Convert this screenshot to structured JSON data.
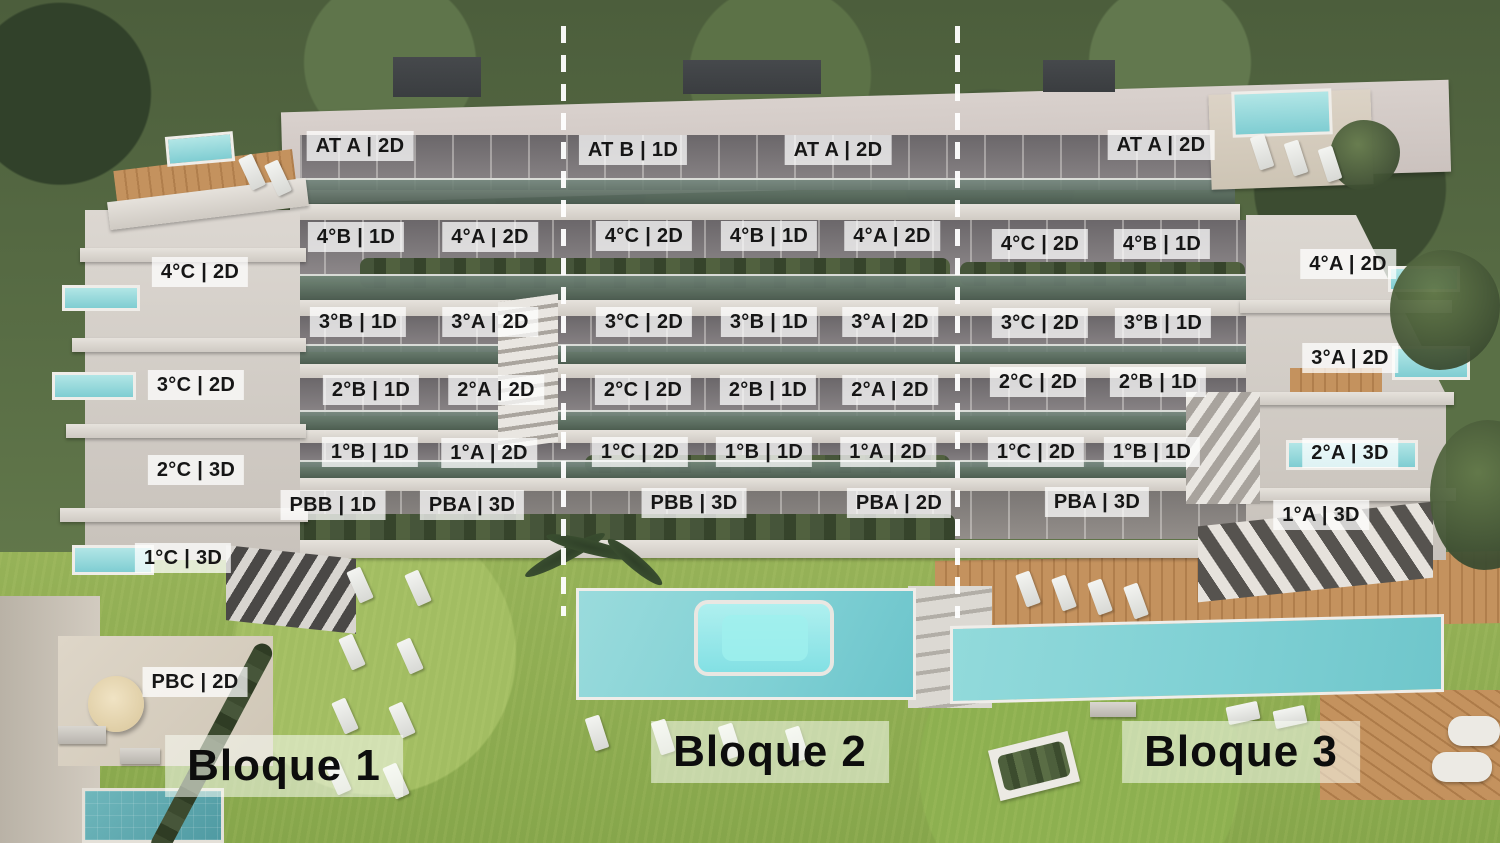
{
  "image": {
    "width": 1500,
    "height": 843
  },
  "colors": {
    "unit_label_bg": "rgba(255,255,255,0.74)",
    "unit_label_text": "#161616",
    "block_label_bg": "rgba(250,253,244,0.55)",
    "divider_line": "#ffffff",
    "building_light": "#dcd7d1",
    "facade_dark": "#6b676a",
    "balcony_glass": "#64736a",
    "hedge_green": "#46553a",
    "trees_green": "#4c5e3c",
    "grass_green": "#96b258",
    "wood_deck": "#c4925e",
    "pool_teal": "#7fd0d4",
    "ground_pool_teal": "#4f9aa2"
  },
  "block_labels": [
    {
      "text": "Bloque 1",
      "x": 284,
      "y": 766
    },
    {
      "text": "Bloque 2",
      "x": 770,
      "y": 752
    },
    {
      "text": "Bloque 3",
      "x": 1241,
      "y": 752
    }
  ],
  "unit_labels": [
    {
      "text": "AT A | 2D",
      "block": 1,
      "x": 360,
      "y": 146
    },
    {
      "text": "4°B | 1D",
      "block": 1,
      "x": 356,
      "y": 237
    },
    {
      "text": "4°A | 2D",
      "block": 1,
      "x": 490,
      "y": 237
    },
    {
      "text": "4°C | 2D",
      "block": 1,
      "x": 200,
      "y": 272
    },
    {
      "text": "3°B | 1D",
      "block": 1,
      "x": 358,
      "y": 322
    },
    {
      "text": "3°A | 2D",
      "block": 1,
      "x": 490,
      "y": 322
    },
    {
      "text": "3°C | 2D",
      "block": 1,
      "x": 196,
      "y": 385
    },
    {
      "text": "2°B | 1D",
      "block": 1,
      "x": 371,
      "y": 390
    },
    {
      "text": "2°A | 2D",
      "block": 1,
      "x": 496,
      "y": 390
    },
    {
      "text": "1°B | 1D",
      "block": 1,
      "x": 370,
      "y": 452
    },
    {
      "text": "1°A | 2D",
      "block": 1,
      "x": 489,
      "y": 453
    },
    {
      "text": "2°C | 3D",
      "block": 1,
      "x": 196,
      "y": 470
    },
    {
      "text": "PBB | 1D",
      "block": 1,
      "x": 333,
      "y": 505
    },
    {
      "text": "PBA | 3D",
      "block": 1,
      "x": 472,
      "y": 505
    },
    {
      "text": "1°C | 3D",
      "block": 1,
      "x": 183,
      "y": 558
    },
    {
      "text": "PBC | 2D",
      "block": 1,
      "x": 195,
      "y": 682
    },
    {
      "text": "AT B | 1D",
      "block": 2,
      "x": 633,
      "y": 150
    },
    {
      "text": "AT A | 2D",
      "block": 2,
      "x": 838,
      "y": 150
    },
    {
      "text": "4°C | 2D",
      "block": 2,
      "x": 644,
      "y": 236
    },
    {
      "text": "4°B | 1D",
      "block": 2,
      "x": 769,
      "y": 236
    },
    {
      "text": "4°A | 2D",
      "block": 2,
      "x": 892,
      "y": 236
    },
    {
      "text": "3°C | 2D",
      "block": 2,
      "x": 644,
      "y": 322
    },
    {
      "text": "3°B | 1D",
      "block": 2,
      "x": 769,
      "y": 322
    },
    {
      "text": "3°A | 2D",
      "block": 2,
      "x": 890,
      "y": 322
    },
    {
      "text": "2°C | 2D",
      "block": 2,
      "x": 643,
      "y": 390
    },
    {
      "text": "2°B | 1D",
      "block": 2,
      "x": 768,
      "y": 390
    },
    {
      "text": "2°A | 2D",
      "block": 2,
      "x": 890,
      "y": 390
    },
    {
      "text": "1°C | 2D",
      "block": 2,
      "x": 640,
      "y": 452
    },
    {
      "text": "1°B | 1D",
      "block": 2,
      "x": 764,
      "y": 452
    },
    {
      "text": "1°A | 2D",
      "block": 2,
      "x": 888,
      "y": 452
    },
    {
      "text": "PBB | 3D",
      "block": 2,
      "x": 694,
      "y": 503
    },
    {
      "text": "PBA | 2D",
      "block": 2,
      "x": 899,
      "y": 503
    },
    {
      "text": "AT A | 2D",
      "block": 3,
      "x": 1161,
      "y": 145
    },
    {
      "text": "4°C | 2D",
      "block": 3,
      "x": 1040,
      "y": 244
    },
    {
      "text": "4°B | 1D",
      "block": 3,
      "x": 1162,
      "y": 244
    },
    {
      "text": "4°A | 2D",
      "block": 3,
      "x": 1348,
      "y": 264
    },
    {
      "text": "3°C | 2D",
      "block": 3,
      "x": 1040,
      "y": 323
    },
    {
      "text": "3°B | 1D",
      "block": 3,
      "x": 1163,
      "y": 323
    },
    {
      "text": "3°A | 2D",
      "block": 3,
      "x": 1350,
      "y": 358
    },
    {
      "text": "2°C | 2D",
      "block": 3,
      "x": 1038,
      "y": 382
    },
    {
      "text": "2°B | 1D",
      "block": 3,
      "x": 1158,
      "y": 382
    },
    {
      "text": "1°C | 2D",
      "block": 3,
      "x": 1036,
      "y": 452
    },
    {
      "text": "1°B | 1D",
      "block": 3,
      "x": 1152,
      "y": 452
    },
    {
      "text": "2°A | 3D",
      "block": 3,
      "x": 1350,
      "y": 453
    },
    {
      "text": "PBA | 3D",
      "block": 3,
      "x": 1097,
      "y": 502
    },
    {
      "text": "1°A | 3D",
      "block": 3,
      "x": 1321,
      "y": 515
    }
  ],
  "dividers": [
    {
      "x": 561,
      "top": 26,
      "height": 590
    },
    {
      "x": 955,
      "top": 26,
      "height": 592
    }
  ],
  "loungers": [
    {
      "x": 360,
      "y": 585,
      "r": -24
    },
    {
      "x": 418,
      "y": 588,
      "r": -24
    },
    {
      "x": 352,
      "y": 652,
      "r": -24
    },
    {
      "x": 410,
      "y": 656,
      "r": -24
    },
    {
      "x": 345,
      "y": 716,
      "r": -24
    },
    {
      "x": 402,
      "y": 720,
      "r": -24
    },
    {
      "x": 338,
      "y": 777,
      "r": -24
    },
    {
      "x": 396,
      "y": 781,
      "r": -24
    },
    {
      "x": 597,
      "y": 733,
      "r": -18
    },
    {
      "x": 663,
      "y": 737,
      "r": -18
    },
    {
      "x": 730,
      "y": 741,
      "r": -18
    },
    {
      "x": 797,
      "y": 744,
      "r": -18
    },
    {
      "x": 1028,
      "y": 589,
      "r": -20
    },
    {
      "x": 1064,
      "y": 593,
      "r": -20
    },
    {
      "x": 1100,
      "y": 597,
      "r": -20
    },
    {
      "x": 1136,
      "y": 601,
      "r": -20
    },
    {
      "x": 1262,
      "y": 152,
      "r": -18
    },
    {
      "x": 1296,
      "y": 158,
      "r": -18
    },
    {
      "x": 1330,
      "y": 164,
      "r": -18
    },
    {
      "x": 252,
      "y": 172,
      "r": -25
    },
    {
      "x": 278,
      "y": 178,
      "r": -25
    },
    {
      "x": 1243,
      "y": 713,
      "r": -12,
      "wide": true
    },
    {
      "x": 1290,
      "y": 717,
      "r": -12,
      "wide": true
    }
  ]
}
